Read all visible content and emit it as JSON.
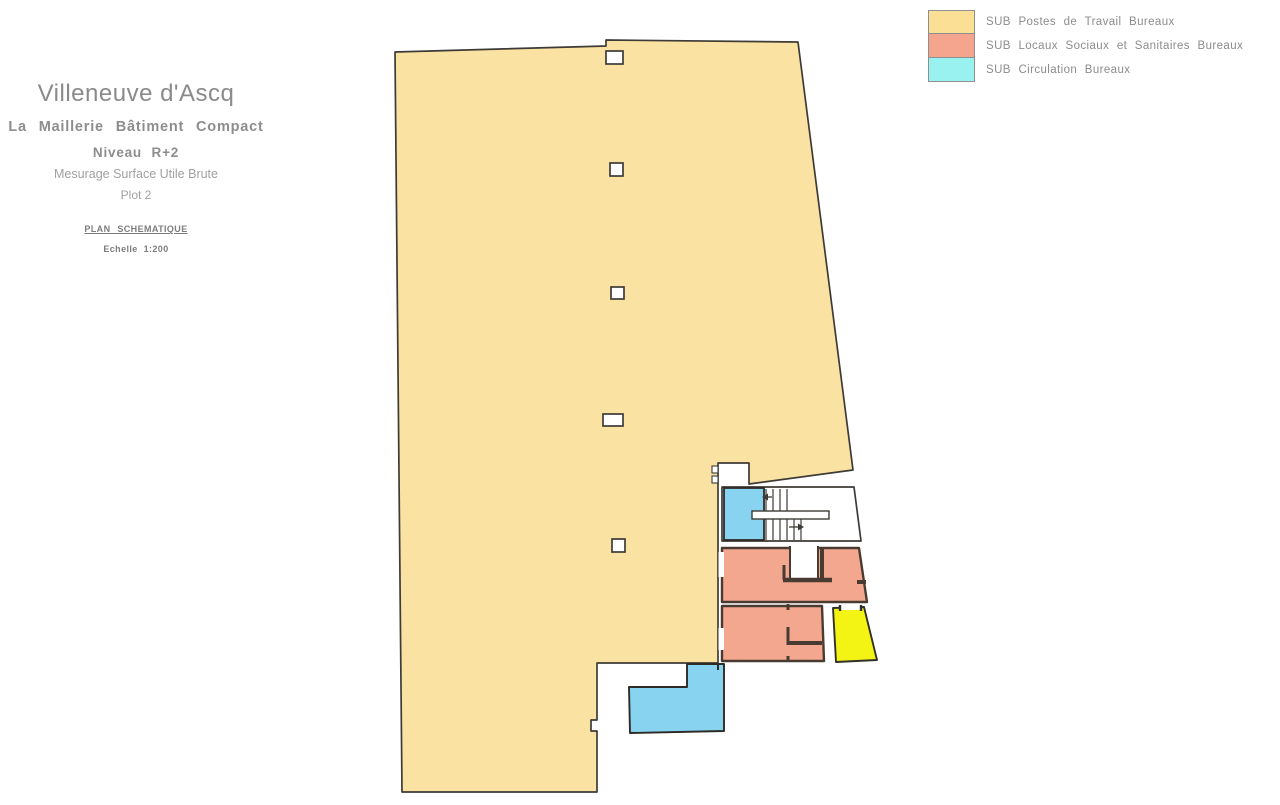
{
  "title_block": {
    "city": "Villeneuve d'Ascq",
    "building": "La Maillerie Bâtiment Compact",
    "level": "Niveau R+2",
    "measure": "Mesurage Surface Utile Brute",
    "plot": "Plot 2",
    "plan_type": "PLAN SCHEMATIQUE",
    "scale": "Echelle 1:200"
  },
  "legend": {
    "items": [
      {
        "label": "SUB Postes de Travail Bureaux",
        "color": "#FBDF94"
      },
      {
        "label": "SUB Locaux Sociaux et Sanitaires Bureaux",
        "color": "#F5A48D"
      },
      {
        "label": "SUB Circulation Bureaux",
        "color": "#9AF2F0"
      }
    ]
  },
  "plan": {
    "colors": {
      "workspace": "#F9E2A2",
      "social": "#F3A78F",
      "circulation": "#87D3F0",
      "highlight": "#F4F414",
      "wall": "#4A3B32",
      "outline": "#3E3B36"
    }
  }
}
